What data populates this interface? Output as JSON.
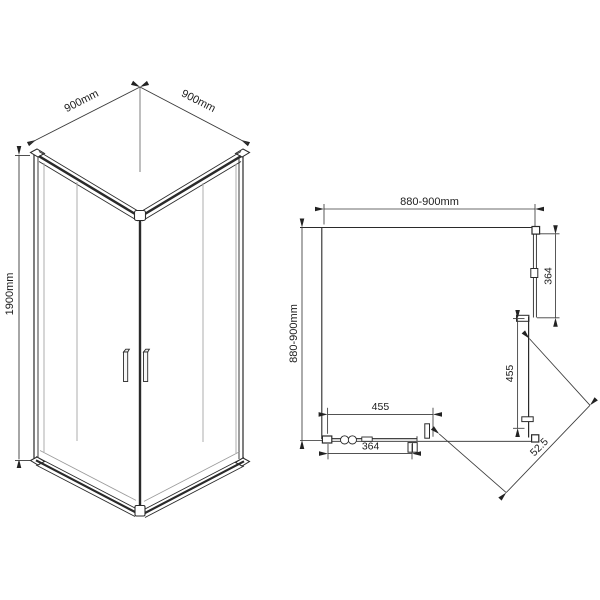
{
  "drawing": {
    "type": "shower-enclosure-technical-drawing",
    "views": {
      "iso_label": "isometric-view",
      "plan_label": "top-plan-view"
    }
  },
  "iso_view": {
    "dim_width_left": "900mm",
    "dim_width_right": "900mm",
    "dim_height": "1900mm"
  },
  "plan_view": {
    "dim_width": "880-900mm",
    "dim_depth": "880-900mm",
    "dim_right_fixed_panel": "364",
    "dim_right_door": "455",
    "dim_bottom_door": "455",
    "dim_bottom_fixed_panel": "364",
    "dim_diagonal_entry": "52.5"
  },
  "colors": {
    "line": "#2a2a2a",
    "glass_line": "#9b9b9b",
    "dimension_line": "#3a3a3a",
    "background": "#ffffff"
  }
}
